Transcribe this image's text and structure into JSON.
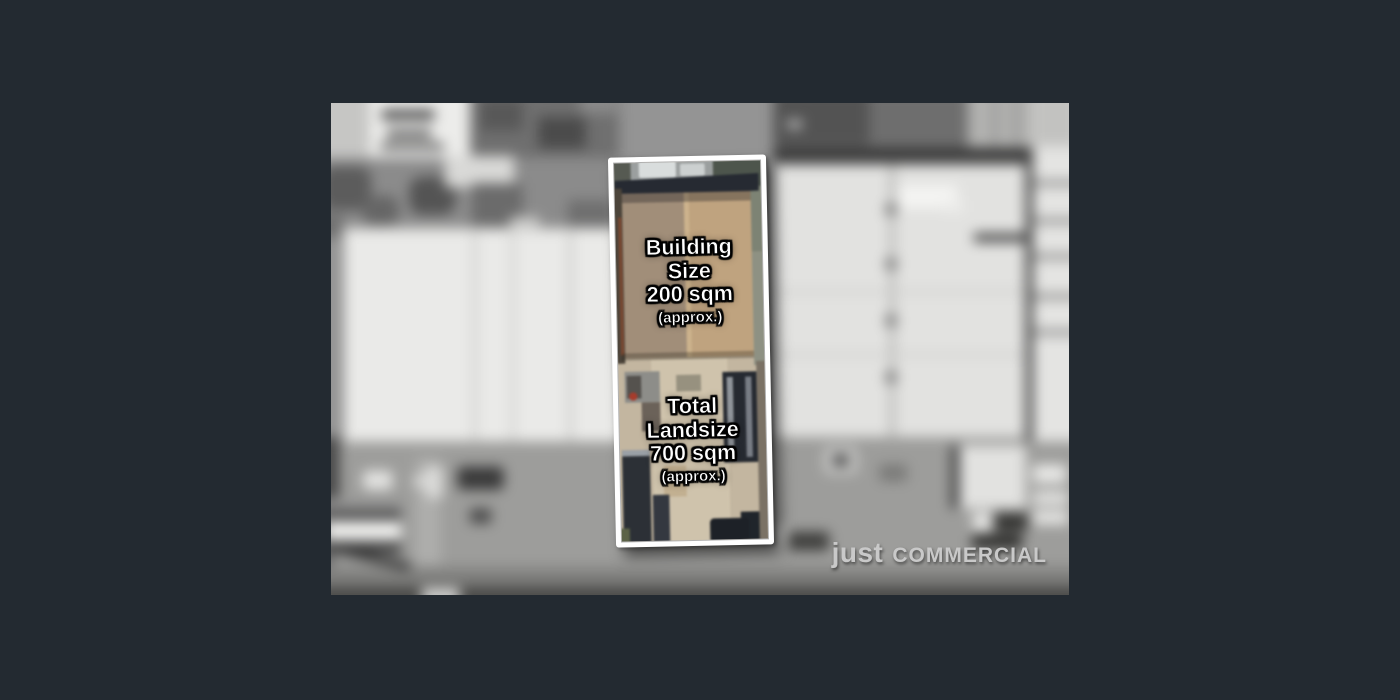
{
  "page": {
    "background_color": "#232a31"
  },
  "aerial_photo": {
    "description": "Blurred grayscale aerial view of an industrial area with warehouse rooftops, driveways and parked vehicles",
    "watermark": {
      "word_just": "just",
      "word_commercial": "COMMERCIAL",
      "color": "#c9c9c9"
    }
  },
  "property_highlight": {
    "frame_color": "#ffffff",
    "building_label": {
      "line1": "Building",
      "line2": "Size",
      "line3": "200 sqm",
      "line4": "(approx.)"
    },
    "landsize_label": {
      "line1": "Total",
      "line2": "Landsize",
      "line3": "700 sqm",
      "line4": "(approx.)"
    },
    "colors": {
      "roof_left": "#a18e79",
      "roof_right": "#bfa37f",
      "yard": "#c3b6a0",
      "text": "#ffffff",
      "text_outline": "#000000"
    }
  }
}
